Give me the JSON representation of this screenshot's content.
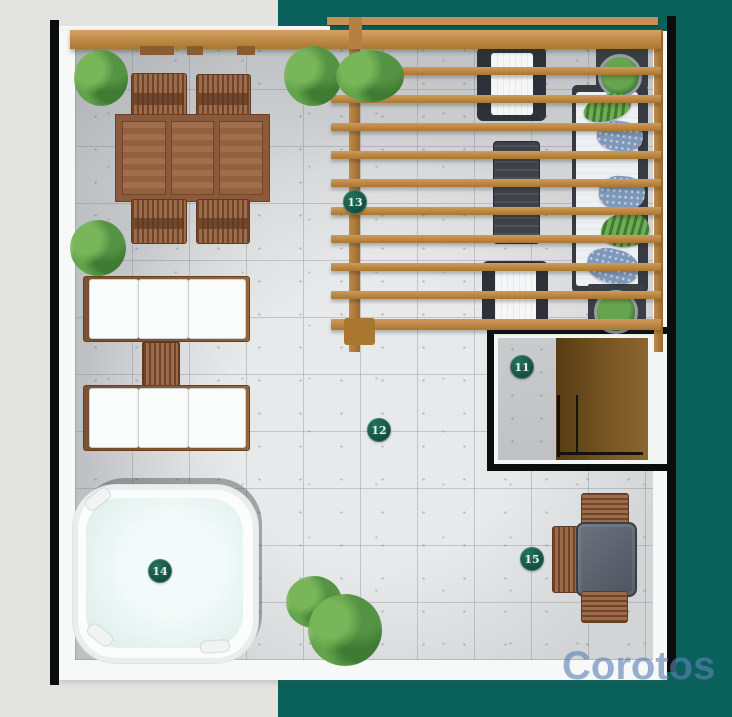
{
  "watermark": {
    "text": "Corotos"
  },
  "markers": [
    {
      "label": "11"
    },
    {
      "label": "12"
    },
    {
      "label": "13"
    },
    {
      "label": "14"
    },
    {
      "label": "15"
    }
  ],
  "palette": {
    "background_left": "#e3e3e1",
    "background_right": "#0a605a",
    "marker_fill": "#124b3b",
    "marker_text": "#edf3ec",
    "pergola_wood": "#c08a48",
    "furniture_wood": "#9c6b49",
    "concrete_floor": "#d2d4d6",
    "jacuzzi_water": "#e2f1ee",
    "plant_green": "#4e8f3e",
    "watermark_blue": "#5d82b5"
  }
}
